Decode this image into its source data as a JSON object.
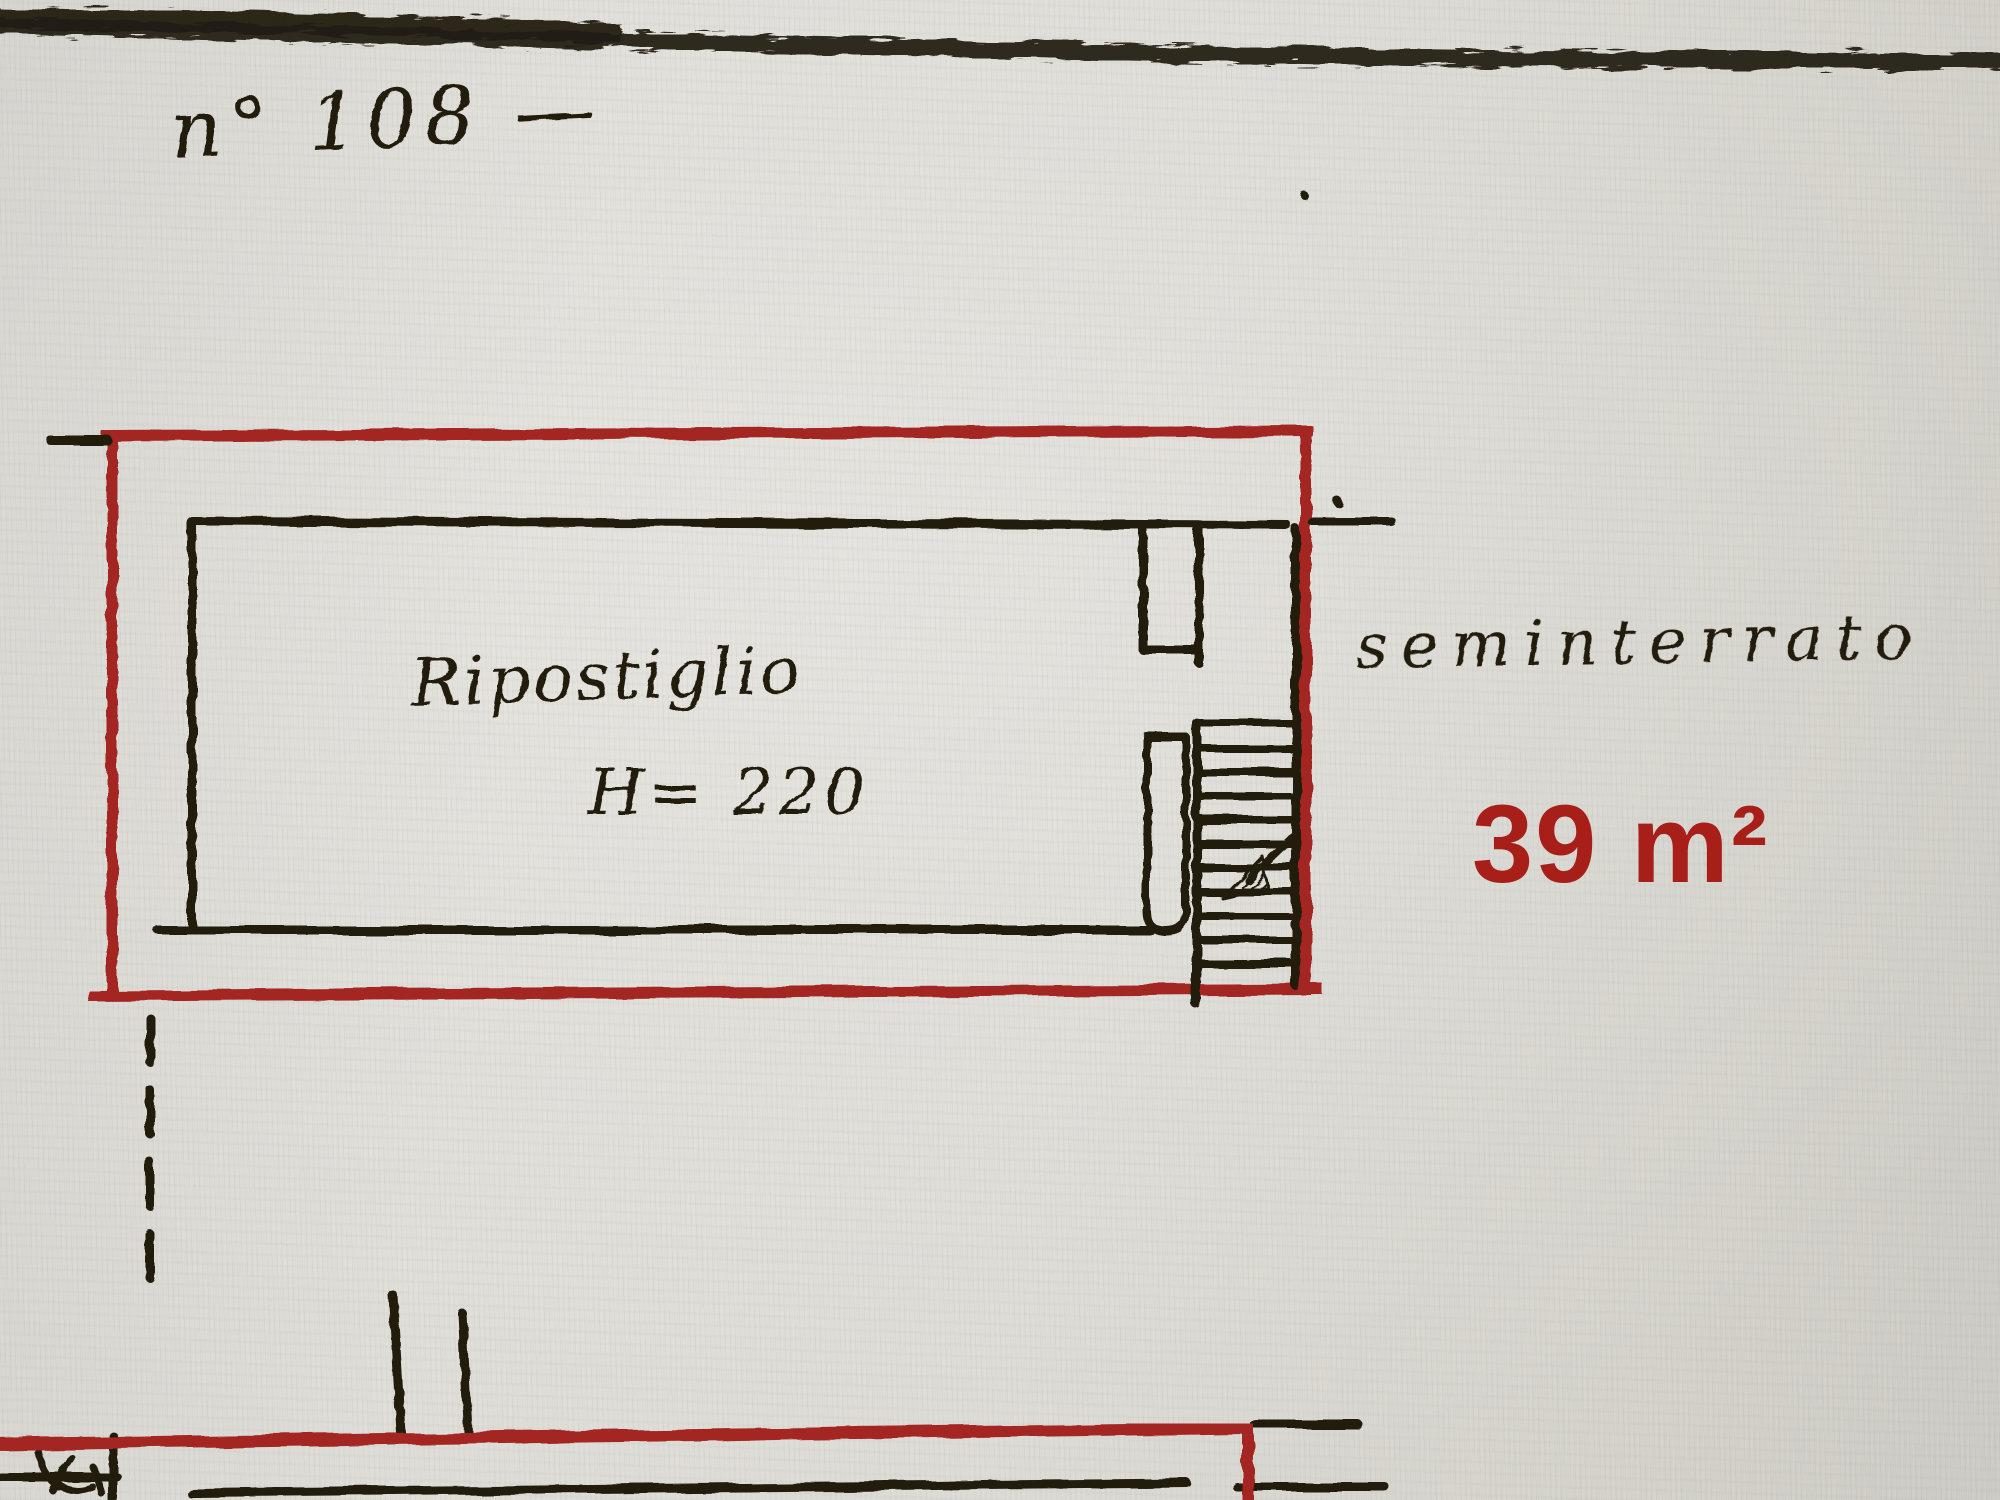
{
  "colors": {
    "paper": "#d9d7d1",
    "ink": "#241b10",
    "red": "#a32522",
    "area-red": "#a81f1a"
  },
  "labels": {
    "plan_number": "n° 108 —",
    "room_name": "Ripostiglio",
    "room_height": "H= 220",
    "floor_name": "seminterrato",
    "area": "39 m²"
  },
  "drawing": {
    "kind": "cadastral floor plan (scanned, hand drawn)",
    "outlined_unit_color_meaning": "red outline = unit n° 108 perimeter",
    "features": [
      "storage room (Ripostiglio, H=220)",
      "staircase with descent arrow",
      "semi-basement level label",
      "area 39 m²",
      "adjacent unit outline at bottom"
    ]
  }
}
